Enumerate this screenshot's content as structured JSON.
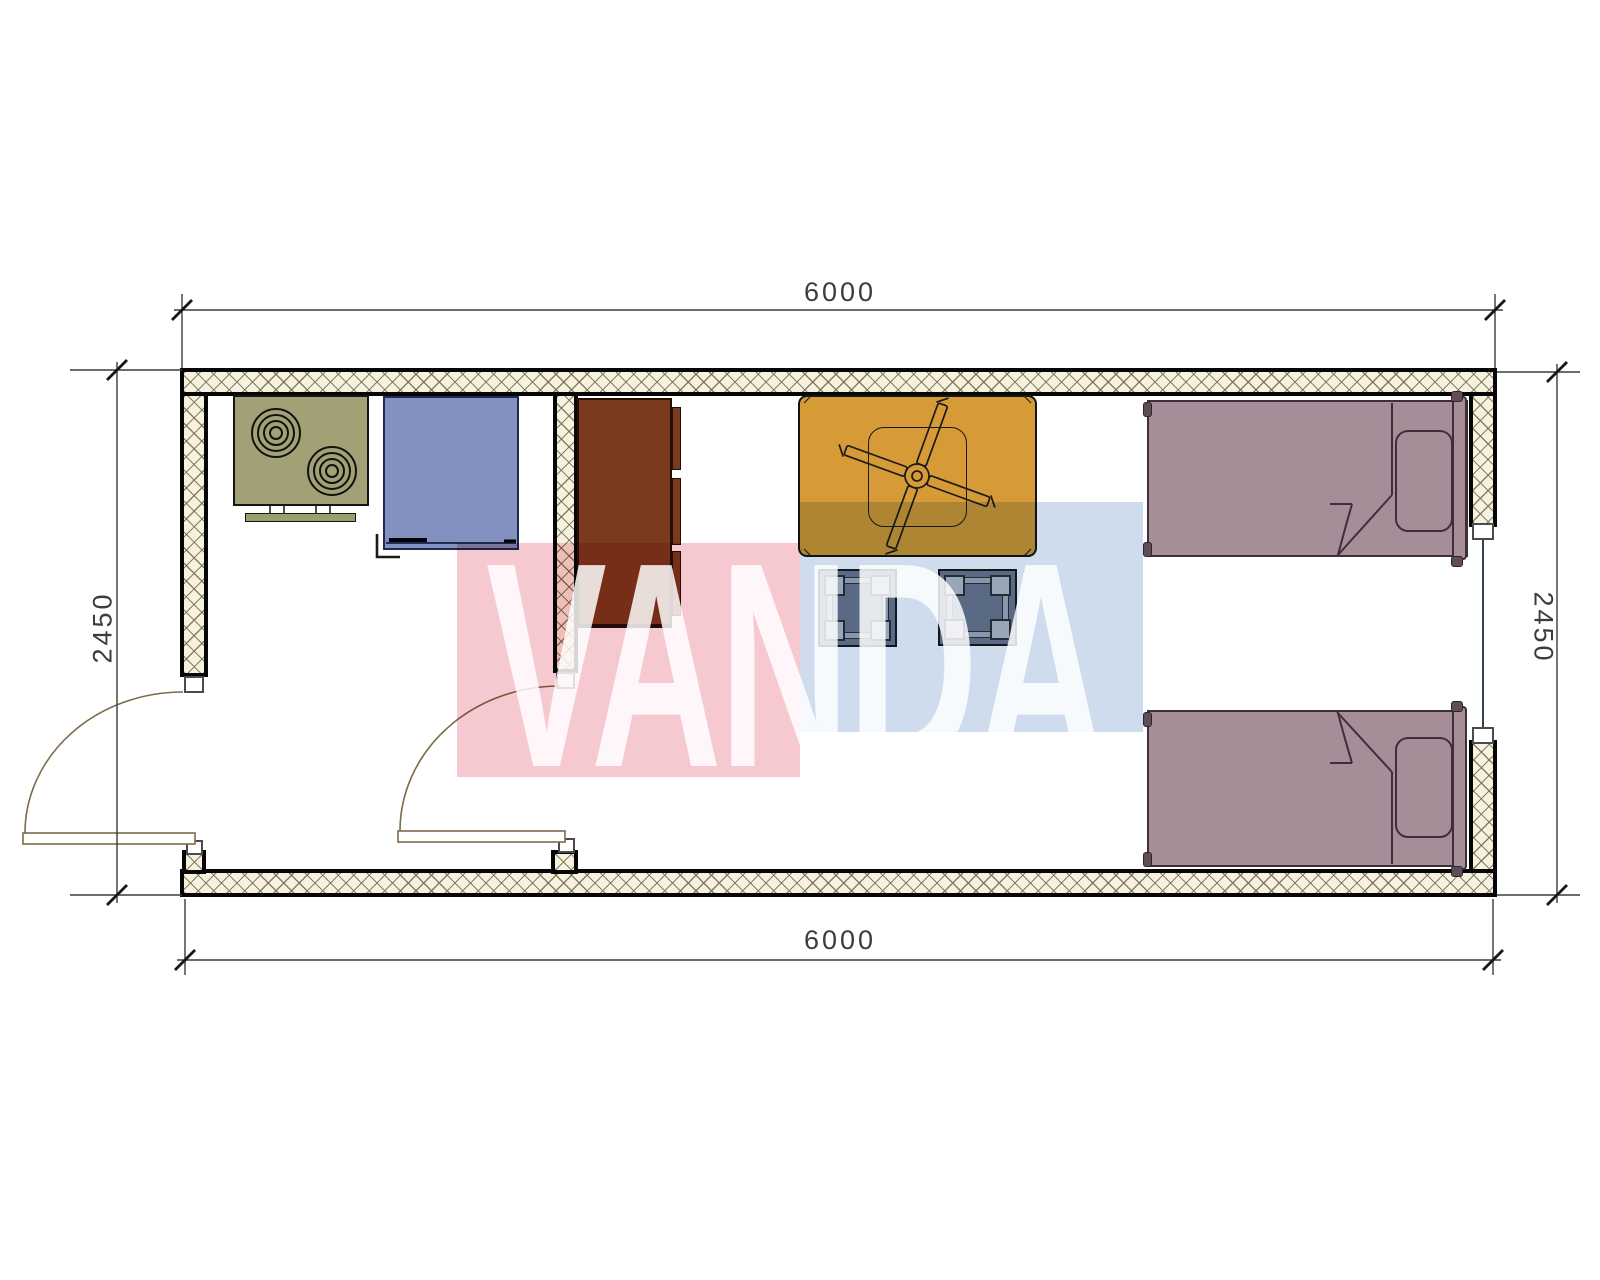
{
  "document": {
    "type": "architectural-floor-plan",
    "description": "single container-unit plan with kitchen and bedroom, two doors, one window, furniture symbols"
  },
  "dimensions": {
    "top": "6000",
    "bottom": "6000",
    "left": "2450",
    "right": "2450"
  },
  "watermark": {
    "text": "VANDA"
  },
  "rooms": [
    {
      "name": "kitchen"
    },
    {
      "name": "living-bedroom"
    }
  ],
  "furniture": {
    "stove": {
      "burners": 2
    },
    "counter_unit": {
      "type": "sink-or-appliance"
    },
    "wardrobe": {
      "drawer_strips": 3
    },
    "table": {
      "overlay": "ceiling-fan-4-blades"
    },
    "stools": 2,
    "beds": 2
  },
  "colors": {
    "hatch_bg": "#f6f2e2",
    "wall_line": "#060606",
    "stove": "#a2a175",
    "counter_blue": "#8291bf",
    "wardrobe_brown": "#7a3a1d",
    "table_orange": "#d69a36",
    "stool_slate": "#6f7b8d",
    "bed_mauve": "#a68e99",
    "bed_line": "#3f2f39",
    "door_line": "#7d6a4a",
    "dim_line": "#3c3c3c",
    "glazing": "#1c2b4a",
    "watermark_pink": "#f6c9d0",
    "watermark_blue": "#cfdcee"
  },
  "css_vars": {
    "--hatch-bg": "#f6f2e2",
    "--stove": "#a2a175",
    "--unit-blue": "#8291bf",
    "--wardrobe": "#7a3a1d",
    "--table": "#d69a36",
    "--stool": "#6f7b8d",
    "--bed": "#a68e99",
    "--bed-line": "#3f2f39",
    "--door": "#7d6a4a",
    "--dim": "#3c3c3c",
    "--wm-pink": "#f6c9d0",
    "--wm-blue": "#cfdcee"
  }
}
